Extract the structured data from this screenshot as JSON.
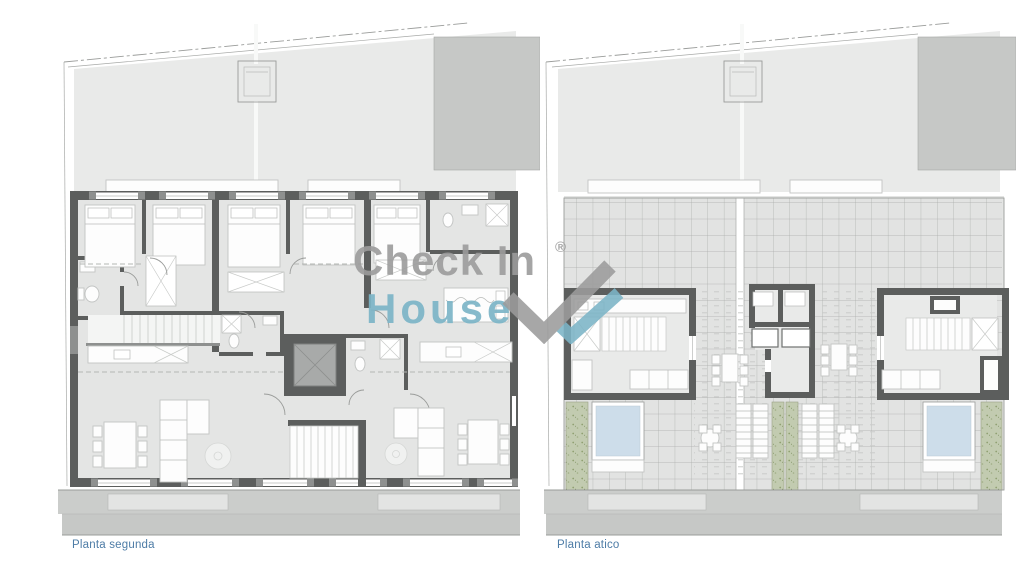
{
  "page": {
    "background": "#ffffff"
  },
  "panels": [
    {
      "label": "Planta segunda",
      "name": "floorplan-second-floor"
    },
    {
      "label": "Planta atico",
      "name": "floorplan-attic-floor"
    }
  ],
  "watermark": {
    "line1": "Check In",
    "line2": "House",
    "registered": "®"
  },
  "colors": {
    "wmGray": "#9c9c9c",
    "wmTeal": "#7cb5c7",
    "label": "#4d7ca6",
    "wall": "#5c5e5d",
    "wallLight": "#8e908f",
    "roof": "#e9eae9",
    "block": "#c6c8c6",
    "floor": "#e4e5e4",
    "floor2": "#e9eae9",
    "terrace": "#e2e3e2",
    "gridLine": "#aaacaa",
    "furnStroke": "#c2c4c3",
    "line": "#9a9c9a",
    "dashed": "#b4b6b4",
    "planter": "#c2cbb0",
    "pool": "#cdddea",
    "band1": "#cbcdcb",
    "band2": "#c6c8c6",
    "bandLight": "#e3e4e3",
    "tread": "#c9cbc9"
  }
}
